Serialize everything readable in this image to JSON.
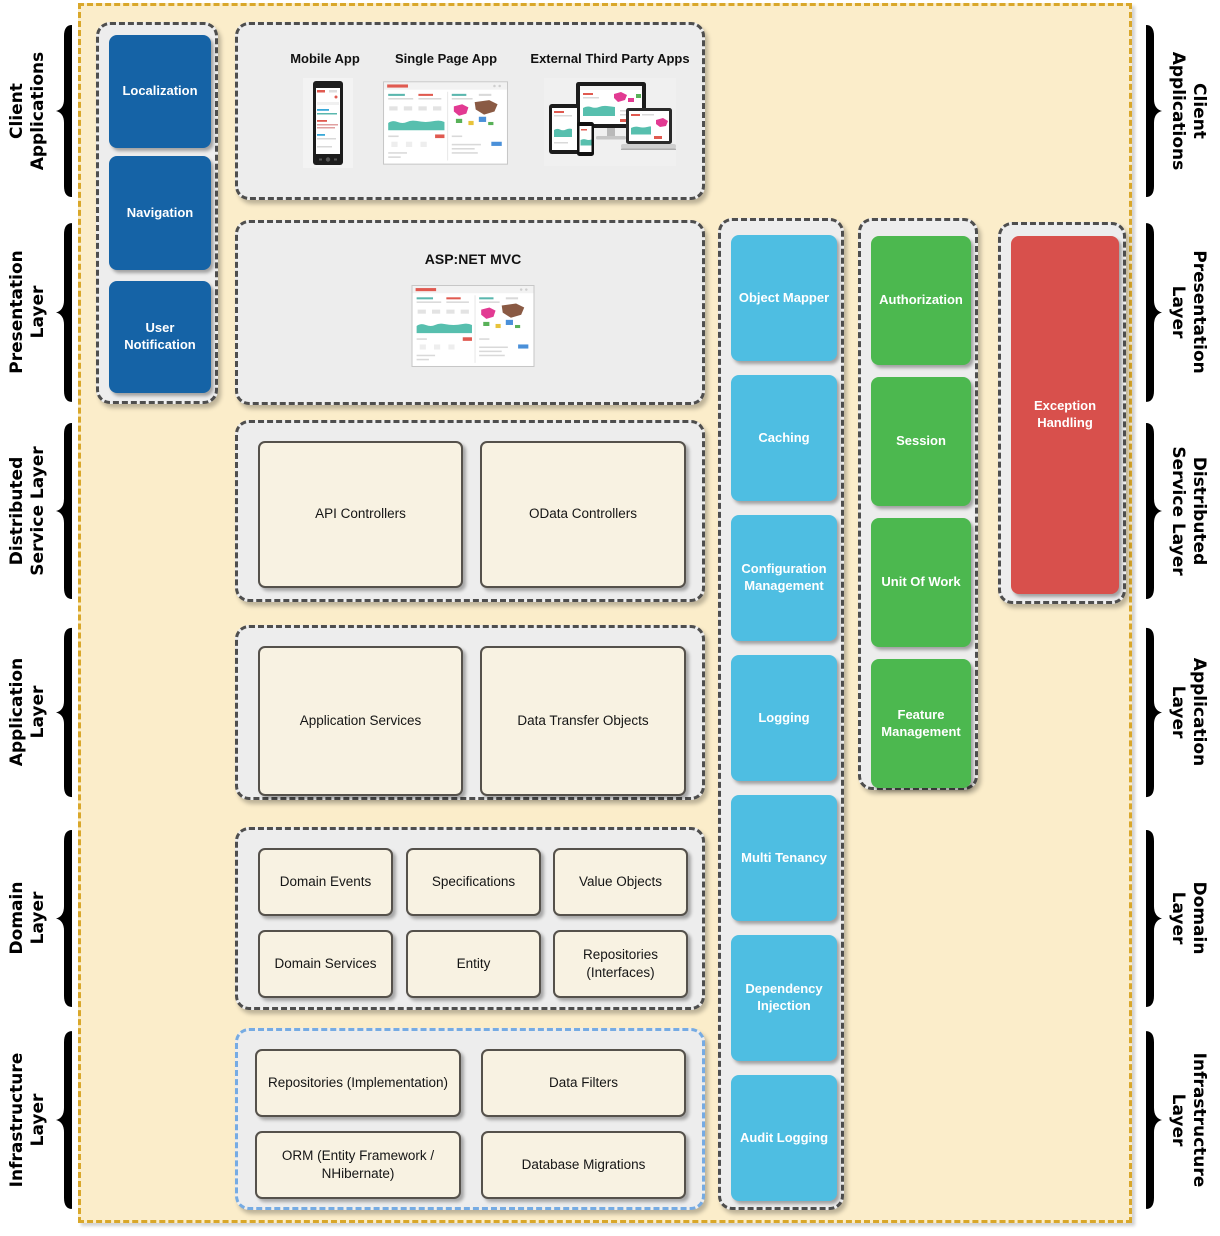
{
  "side_labels": [
    {
      "line1": "Client",
      "line2": "Applications"
    },
    {
      "line1": "Presentation",
      "line2": "Layer"
    },
    {
      "line1": "Distributed",
      "line2": "Service Layer"
    },
    {
      "line1": "Application",
      "line2": "Layer"
    },
    {
      "line1": "Domain",
      "line2": "Layer"
    },
    {
      "line1": "Infrastructure",
      "line2": "Layer"
    }
  ],
  "presentation_modules": {
    "boxes": [
      "Localization",
      "Navigation",
      "User Notification"
    ]
  },
  "client_apps": {
    "labels": [
      "Mobile App",
      "Single Page App",
      "External Third Party Apps"
    ]
  },
  "mvc": {
    "title": "ASP:NET MVC"
  },
  "distributed_service": {
    "boxes": [
      "API Controllers",
      "OData Controllers"
    ]
  },
  "application_layer": {
    "boxes": [
      "Application Services",
      "Data Transfer Objects"
    ]
  },
  "domain_layer": {
    "boxes": [
      "Domain Events",
      "Specifications",
      "Value Objects",
      "Domain Services",
      "Entity",
      "Repositories (Interfaces)"
    ]
  },
  "infrastructure_layer": {
    "boxes": [
      "Repositories (Implementation)",
      "Data Filters",
      "ORM (Entity Framework / NHibernate)",
      "Database Migrations"
    ]
  },
  "cross_cutting": {
    "boxes": [
      "Object Mapper",
      "Caching",
      "Configuration Management",
      "Logging",
      "Multi Tenancy",
      "Dependency Injection",
      "Audit Logging"
    ]
  },
  "framework_services": {
    "boxes": [
      "Authorization",
      "Session",
      "Unit Of Work",
      "Feature Management"
    ]
  },
  "exception": {
    "label": "Exception Handling"
  },
  "colors": {
    "blue": "#1563A6",
    "cyan": "#4EBEE2",
    "green": "#4CB84F",
    "red": "#D8504C",
    "tan_bg": "#FBEDCA",
    "tan_border": "#D9A72A",
    "container_bg": "#EDEDED",
    "container_border": "#4E4E4E",
    "cream": "#F8F2E2",
    "infra_border": "#76ABE3"
  }
}
